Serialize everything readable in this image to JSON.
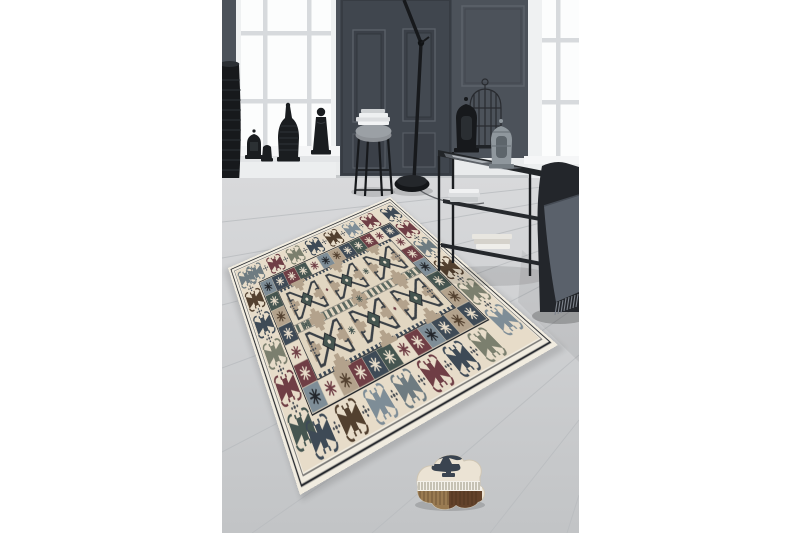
{
  "meta": {
    "alt": "Studio product photo of a beige patchwork kilim-style area rug with navy, maroon, slate and brown tribal hook motifs, staged in a dark grey panelled room with white sash windows, black lanterns and a Buddha figure on the windowsill, a tall ribbed floor vase, a black floor lamp, a thin-legged side stand with magazines, a black two-tier console table with lanterns and a birdcage, and a charcoal armchair with a fringed grey throw, all on a light grey plank wood floor; a small folded corner piece of the rug lies in the foreground",
    "image_width": 800,
    "image_height": 533
  },
  "photo": {
    "left": 222,
    "top": 0,
    "width": 357,
    "height": 533
  },
  "palette": {
    "wall": "#4c525a",
    "door": "#40464e",
    "doorTrim": "#5a6068",
    "frame": "#eff1f2",
    "pane": "#fcfdfd",
    "muntin": "#d7dadd",
    "sill": "#f5f6f7",
    "baseboard": "#e9ebec",
    "floor": "#d6d7d9",
    "floorDark": "#c3c5c7",
    "floorLine": "#b9bcbf",
    "black": "#17191c",
    "metal": "#8f979d",
    "glass": "#a8b0b7",
    "chair": "#23262b",
    "throw": "#5a616b",
    "fringe": "#7e848d",
    "rugWhite": "#f1ece0",
    "rugCream": "#e7dcc9",
    "rugField": "#e1d6c1",
    "rugBlack": "#23262b",
    "rugLine": "#3a4046",
    "rugNavy": "#3e4a56",
    "rugMaroon": "#6f3e45",
    "rugSlate": "#6e7b81",
    "rugBrown": "#52402f",
    "rugSage": "#7b7f6e",
    "rugBlue": "#7e8d97",
    "rugTeal": "#455550",
    "rugTaupe": "#b3a28c",
    "foldCream": "#ebe3d4",
    "foldNavy": "#3a4450",
    "woodLight": "#9a7b52",
    "woodDark": "#63422a",
    "shadow": "#000000"
  },
  "scene": {
    "backdrop": "white studio background, portrait photo centered",
    "elements": [
      {
        "name": "panelled-wall",
        "desc": "dark grey wall with recessed moulding panels"
      },
      {
        "name": "panelled-door",
        "desc": "dark grey door with four recessed panels"
      },
      {
        "name": "left-sash-window",
        "desc": "white framed window, bright daylight panes"
      },
      {
        "name": "right-sash-window",
        "desc": "white framed window partially cropped at right edge"
      },
      {
        "name": "windowsill-decor",
        "desc": "black moroccan lantern, small jar, tall carved bottle vase, standing buddha figure"
      },
      {
        "name": "floor-vase",
        "desc": "tall black ribbed floor vase at left edge"
      },
      {
        "name": "floor-lamp",
        "desc": "black task floor lamp with dome base and jointed pole"
      },
      {
        "name": "side-stand",
        "desc": "thin black metal stand with grey cushion and white magazines"
      },
      {
        "name": "console-table",
        "desc": "black metal two-tier console with glass top, books, black lantern, silver lantern and wire birdcage"
      },
      {
        "name": "armchair",
        "desc": "charcoal armchair draped with a fringed grey throw"
      },
      {
        "name": "wood-floor",
        "desc": "light grey wide plank floor in perspective"
      },
      {
        "name": "area-rug",
        "desc": "patchwork kilim rug laid diagonally on the floor"
      },
      {
        "name": "folded-rug-piece",
        "desc": "small folded rug corner showing navy bird motif, white fringe and woven brown back"
      }
    ]
  },
  "rug": {
    "style": "patchwork kilim / tribal",
    "field_color_name": "beige-cream",
    "layout": "2 columns x 3 rows of hooked X-star medallions with striped band between columns",
    "border": "outer cream band with black pinstripes, ring of hooked bow-tie motifs, inner ring of patchwork squares",
    "motif_colors": [
      "navy",
      "maroon",
      "slate",
      "brown",
      "sage",
      "grey-blue",
      "teal",
      "taupe"
    ]
  }
}
